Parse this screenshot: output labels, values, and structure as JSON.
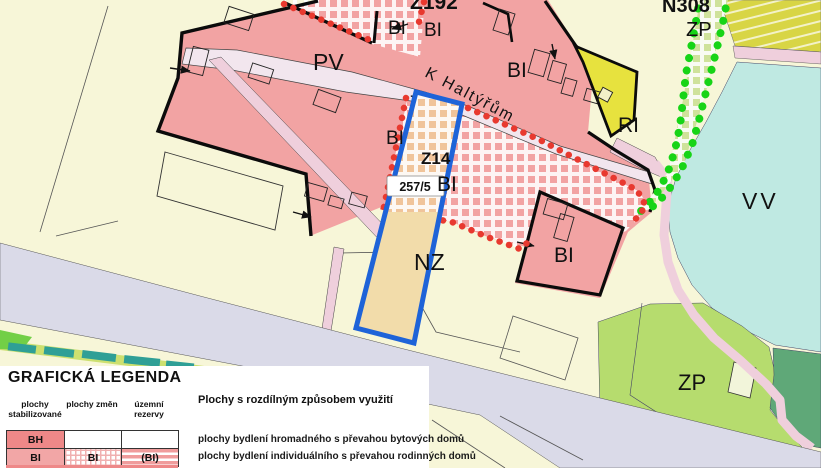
{
  "map": {
    "area_labels": {
      "z192": "Z192",
      "bi_top_left": "BI",
      "bi_top_mid": "BI",
      "bi_top_right": "BI",
      "pv": "PV",
      "street_name": "K Haltýřům",
      "bi_left": "BI",
      "z14": "Z14",
      "bi_center": "BI",
      "parcel_number": "257/5",
      "nz": "NZ",
      "bi_right": "BI",
      "ri": "RI",
      "vv": "VV",
      "n308": "N308",
      "zp_top": "ZP",
      "zp_bottom": "ZP"
    },
    "colors": {
      "background": "#f7f6d8",
      "residential_pink": "#f2a3a3",
      "road": "#f2e6ee",
      "road_pink": "#efcfdc",
      "corridor_lavender": "#dadae8",
      "water_cyan": "#bfe9e2",
      "greenery": "#b6dc6e",
      "greenery_dark": "#5fa878",
      "recreation_yellow": "#e7e23e",
      "parcel_fill_tan": "#f2dcaa",
      "hatch_tan": "#f0c49a",
      "parcel_outline_blue": "#1e63d8",
      "boundary_red_dots": "#e8392f",
      "boundary_green_dots": "#17d417",
      "label_purple": "#4a1fb8",
      "label_blue": "#2433c8"
    }
  },
  "legend": {
    "title": "GRAFICKÁ LEGENDA",
    "col_headers": [
      "plochy stabilizované",
      "plochy změn",
      "územní rezervy"
    ],
    "section_header": "Plochy s rozdílným způsobem využití",
    "rows": [
      {
        "stab": "BH",
        "zmen": "",
        "rez": "",
        "desc": "plochy bydlení hromadného s převahou bytových domů"
      },
      {
        "stab": "BI",
        "zmen": "BI",
        "rez": "(BI)",
        "desc": "plochy bydlení individuálního s převahou rodinných domů"
      }
    ]
  }
}
